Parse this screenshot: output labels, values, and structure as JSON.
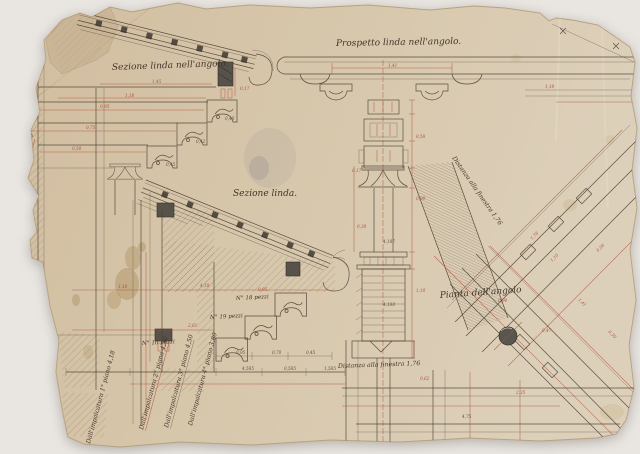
{
  "titles": {
    "section_corner": "Sezione linda nell'angolo.",
    "elevation_corner": "Prospetto linda nell'angolo.",
    "section": "Sezione linda.",
    "plan_corner": "Pianta dell'angolo",
    "distance_window_diagonal": "Distanza alla finestra 1,76",
    "distance_window_bottom": "Distanza alla finestra 1,76"
  },
  "piece_counts": [
    "N° 18 pezzi",
    "N° 19 pezzi",
    "N° 10 pezzi"
  ],
  "scaffold_notes": [
    "Dall'impalcatura 1° piano 4,18",
    "Dall'impalcatura 2° piano 4,30",
    "Dall'impalcatura 3° piano 4,50",
    "Dall'impalcatura 4° piano 3,80",
    "Dall'impalcatura N 7. 9,30"
  ],
  "colors": {
    "background": "#e9e6e2",
    "paper": "#d6c6ab",
    "paper_edge": "#b7a281",
    "ink": "#4e4033",
    "dimension_red": "#b2503f",
    "stain_brown": "#8a6325"
  },
  "dimension_marks": [
    {
      "x": 152,
      "y": 83,
      "t": "1,45",
      "c": "red"
    },
    {
      "x": 125,
      "y": 97,
      "t": "1,18",
      "c": "red"
    },
    {
      "x": 100,
      "y": 108,
      "t": "0,95",
      "c": "red"
    },
    {
      "x": 86,
      "y": 129,
      "t": "0,75",
      "c": "red"
    },
    {
      "x": 72,
      "y": 150,
      "t": "0,58",
      "c": "red"
    },
    {
      "x": 240,
      "y": 90,
      "t": "0,17",
      "c": "red"
    },
    {
      "x": 225,
      "y": 120,
      "t": "0,40",
      "c": "ink"
    },
    {
      "x": 196,
      "y": 143,
      "t": "0,42",
      "c": "ink"
    },
    {
      "x": 166,
      "y": 166,
      "t": "0,45",
      "c": "ink"
    },
    {
      "x": 388,
      "y": 67,
      "t": "1,41",
      "c": "red"
    },
    {
      "x": 545,
      "y": 88,
      "t": "1,10",
      "c": "red"
    },
    {
      "x": 416,
      "y": 138,
      "t": "0,58",
      "c": "red"
    },
    {
      "x": 416,
      "y": 200,
      "t": "0,90",
      "c": "red"
    },
    {
      "x": 416,
      "y": 292,
      "t": "1,10",
      "c": "red"
    },
    {
      "x": 383,
      "y": 243,
      "t": "4,187",
      "c": "ink"
    },
    {
      "x": 383,
      "y": 306,
      "t": "4,188",
      "c": "ink"
    },
    {
      "x": 357,
      "y": 228,
      "t": "0,30",
      "c": "red"
    },
    {
      "x": 352,
      "y": 172,
      "t": "0,17",
      "c": "red"
    },
    {
      "x": 200,
      "y": 287,
      "t": "4,18",
      "c": "red"
    },
    {
      "x": 258,
      "y": 291,
      "t": "0,95",
      "c": "red"
    },
    {
      "x": 188,
      "y": 327,
      "t": "2,61",
      "c": "red"
    },
    {
      "x": 118,
      "y": 288,
      "t": "1,10",
      "c": "red"
    },
    {
      "x": 236,
      "y": 354,
      "t": "0,95",
      "c": "ink"
    },
    {
      "x": 272,
      "y": 354,
      "t": "0,70",
      "c": "ink"
    },
    {
      "x": 306,
      "y": 354,
      "t": "0,45",
      "c": "ink"
    },
    {
      "x": 242,
      "y": 370,
      "t": "4,585",
      "c": "ink"
    },
    {
      "x": 284,
      "y": 370,
      "t": "0,585",
      "c": "ink"
    },
    {
      "x": 324,
      "y": 370,
      "t": "1,585",
      "c": "ink"
    },
    {
      "x": 532,
      "y": 240,
      "t": "1,76",
      "c": "red",
      "r": -45
    },
    {
      "x": 552,
      "y": 262,
      "t": "1,10",
      "c": "red",
      "r": -45
    },
    {
      "x": 498,
      "y": 302,
      "t": "0,90",
      "c": "red"
    },
    {
      "x": 542,
      "y": 332,
      "t": "0,47",
      "c": "red"
    },
    {
      "x": 578,
      "y": 300,
      "t": "1,41",
      "c": "red",
      "r": 45
    },
    {
      "x": 462,
      "y": 418,
      "t": "4,75",
      "c": "ink"
    },
    {
      "x": 516,
      "y": 394,
      "t": "2,35",
      "c": "red"
    },
    {
      "x": 598,
      "y": 252,
      "t": "0,58",
      "c": "red",
      "r": -45
    },
    {
      "x": 608,
      "y": 332,
      "t": "0,30",
      "c": "red",
      "r": 45
    },
    {
      "x": 420,
      "y": 380,
      "t": "0,62",
      "c": "red"
    }
  ]
}
